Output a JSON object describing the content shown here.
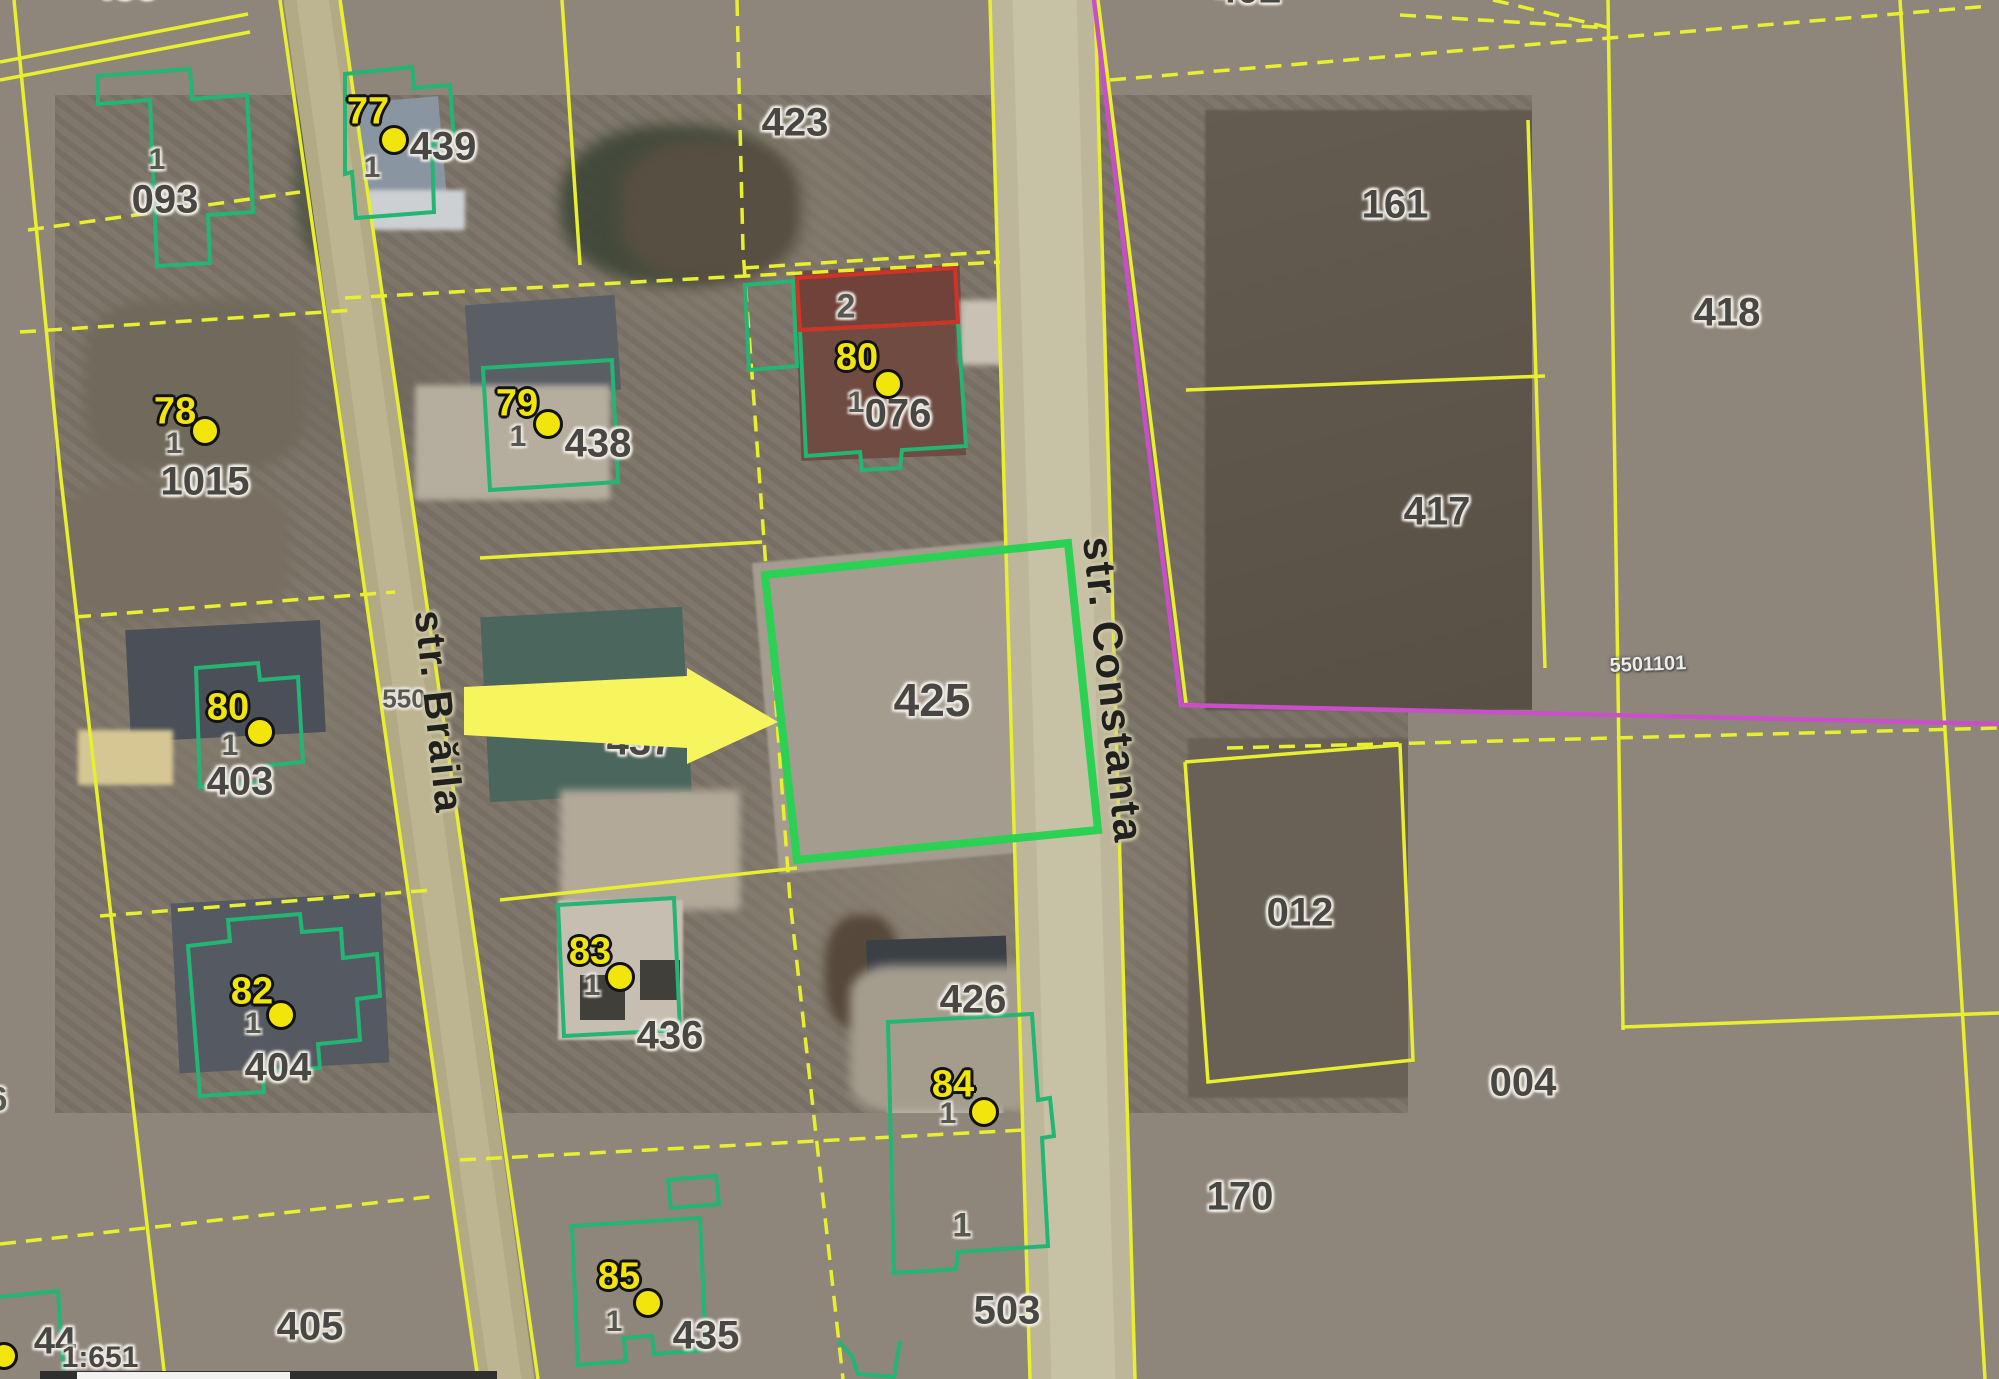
{
  "map": {
    "scale_text": "1:651",
    "corner_marker": "44",
    "highlighted_parcel": "425",
    "edge_fragment": "6"
  },
  "colors": {
    "background": "#8e857b",
    "parcel_line": "#e8ef2e",
    "building_outline": "#22b573",
    "highlight_outline": "#2bd153",
    "red_outline": "#cf3226",
    "restriction_line": "#c94fc9",
    "marker_yellow": "#f2e50c",
    "arrow_fill": "#f7f55e",
    "road_fill": "#b2aa84"
  },
  "streets": [
    {
      "name": "str. Brăila",
      "x": 438,
      "y": 712,
      "rot": 84,
      "size": 40
    },
    {
      "name": "str. Constanta",
      "x": 1113,
      "y": 690,
      "rot": 84,
      "size": 42
    }
  ],
  "parcel_labels": [
    {
      "text": "093",
      "x": 165,
      "y": 200,
      "size": 40
    },
    {
      "text": "1015",
      "x": 205,
      "y": 482,
      "size": 40
    },
    {
      "text": "403",
      "x": 240,
      "y": 782,
      "size": 40
    },
    {
      "text": "404",
      "x": 278,
      "y": 1068,
      "size": 40
    },
    {
      "text": "405",
      "x": 310,
      "y": 1327,
      "size": 40
    },
    {
      "text": "435",
      "x": 706,
      "y": 1336,
      "size": 40
    },
    {
      "text": "436",
      "x": 670,
      "y": 1036,
      "size": 40
    },
    {
      "text": "437",
      "x": 640,
      "y": 742,
      "size": 40
    },
    {
      "text": "438",
      "x": 598,
      "y": 444,
      "size": 40
    },
    {
      "text": "439",
      "x": 443,
      "y": 147,
      "size": 40
    },
    {
      "text": "423",
      "x": 795,
      "y": 123,
      "size": 40
    },
    {
      "text": "425",
      "x": 932,
      "y": 700,
      "size": 46
    },
    {
      "text": "426",
      "x": 973,
      "y": 1000,
      "size": 40
    },
    {
      "text": "076",
      "x": 898,
      "y": 414,
      "size": 40
    },
    {
      "text": "503",
      "x": 1007,
      "y": 1311,
      "size": 40
    },
    {
      "text": "161",
      "x": 1395,
      "y": 205,
      "size": 40
    },
    {
      "text": "417",
      "x": 1437,
      "y": 512,
      "size": 40
    },
    {
      "text": "418",
      "x": 1727,
      "y": 313,
      "size": 40
    },
    {
      "text": "012",
      "x": 1300,
      "y": 913,
      "size": 40
    },
    {
      "text": "004",
      "x": 1523,
      "y": 1083,
      "size": 40
    },
    {
      "text": "170",
      "x": 1240,
      "y": 1197,
      "size": 40
    },
    {
      "text": "402",
      "x": 1248,
      "y": -10,
      "size": 40
    },
    {
      "text": "400",
      "x": 125,
      "y": -14,
      "size": 40
    }
  ],
  "small_labels": [
    {
      "text": "1",
      "x": 157,
      "y": 160,
      "size": 30
    },
    {
      "text": "1",
      "x": 962,
      "y": 1226,
      "size": 34
    },
    {
      "text": "2",
      "x": 846,
      "y": 307,
      "size": 34
    },
    {
      "text": "550",
      "x": 404,
      "y": 699,
      "size": 26
    },
    {
      "text": "6",
      "x": -2,
      "y": 1100,
      "size": 34
    }
  ],
  "ref_labels": [
    {
      "text": "5501101",
      "x": 1648,
      "y": 665,
      "size": 20
    }
  ],
  "corner_labels": [
    {
      "text": "44",
      "x": 55,
      "y": 1342,
      "size": 38
    },
    {
      "text": "1:651",
      "x": 100,
      "y": 1358,
      "size": 30
    }
  ],
  "markers": [
    {
      "num": "77",
      "nx": 368,
      "ny": 112,
      "dx": 394,
      "dy": 140,
      "ox": 372,
      "oy": 168
    },
    {
      "num": "78",
      "nx": 175,
      "ny": 412,
      "dx": 205,
      "dy": 431,
      "ox": 174,
      "oy": 444
    },
    {
      "num": "79",
      "nx": 517,
      "ny": 404,
      "dx": 548,
      "dy": 424,
      "ox": 518,
      "oy": 437
    },
    {
      "num": "80",
      "nx": 857,
      "ny": 358,
      "dx": 888,
      "dy": 384,
      "ox": 856,
      "oy": 403
    },
    {
      "num": "80",
      "nx": 228,
      "ny": 708,
      "dx": 260,
      "dy": 732,
      "ox": 230,
      "oy": 746
    },
    {
      "num": "82",
      "nx": 252,
      "ny": 992,
      "dx": 281,
      "dy": 1015,
      "ox": 253,
      "oy": 1024
    },
    {
      "num": "83",
      "nx": 590,
      "ny": 952,
      "dx": 620,
      "dy": 977,
      "ox": 592,
      "oy": 986
    },
    {
      "num": "84",
      "nx": 953,
      "ny": 1085,
      "dx": 984,
      "dy": 1112,
      "ox": 948,
      "oy": 1114
    },
    {
      "num": "85",
      "nx": 619,
      "ny": 1277,
      "dx": 648,
      "dy": 1303,
      "ox": 614,
      "oy": 1322
    }
  ],
  "geometry": {
    "roads": [
      {
        "p": [
          [
            310,
            -20
          ],
          [
            508,
            1399
          ]
        ],
        "w": 58,
        "c": "#b2aa84"
      },
      {
        "p": [
          [
            310,
            -20
          ],
          [
            508,
            1399
          ]
        ],
        "w": 32,
        "c": "#bdb591"
      },
      {
        "p": [
          [
            1042,
            -20
          ],
          [
            1082,
            1399
          ]
        ],
        "w": 106,
        "c": "#bdb69a"
      },
      {
        "p": [
          [
            1044,
            -20
          ],
          [
            1084,
            1399
          ]
        ],
        "w": 64,
        "c": "#c7c1a6"
      }
    ],
    "yellow_lines": [
      {
        "p": [
          [
            0,
            62
          ],
          [
            248,
            14
          ]
        ],
        "d": 0
      },
      {
        "p": [
          [
            0,
            80
          ],
          [
            250,
            32
          ]
        ],
        "d": 0
      },
      {
        "p": [
          [
            14,
            0
          ],
          [
            60,
            470
          ],
          [
            108,
            890
          ],
          [
            165,
            1379
          ]
        ],
        "d": 0
      },
      {
        "p": [
          [
            28,
            230
          ],
          [
            300,
            192
          ]
        ],
        "d": 1
      },
      {
        "p": [
          [
            20,
            332
          ],
          [
            355,
            310
          ]
        ],
        "d": 1
      },
      {
        "p": [
          [
            75,
            617
          ],
          [
            395,
            592
          ]
        ],
        "d": 1
      },
      {
        "p": [
          [
            100,
            916
          ],
          [
            432,
            890
          ]
        ],
        "d": 1
      },
      {
        "p": [
          [
            0,
            1244
          ],
          [
            437,
            1196
          ]
        ],
        "d": 1
      },
      {
        "p": [
          [
            280,
            0
          ],
          [
            478,
            1379
          ]
        ],
        "d": 0
      },
      {
        "p": [
          [
            340,
            0
          ],
          [
            538,
            1379
          ]
        ],
        "d": 0
      },
      {
        "p": [
          [
            562,
            0
          ],
          [
            580,
            265
          ]
        ],
        "d": 0
      },
      {
        "p": [
          [
            345,
            298
          ],
          [
            1000,
            262
          ]
        ],
        "d": 1
      },
      {
        "p": [
          [
            480,
            558
          ],
          [
            762,
            542
          ]
        ],
        "d": 0
      },
      {
        "p": [
          [
            500,
            900
          ],
          [
            797,
            868
          ]
        ],
        "d": 0
      },
      {
        "p": [
          [
            460,
            1160
          ],
          [
            1023,
            1130
          ]
        ],
        "d": 1
      },
      {
        "p": [
          [
            737,
            0
          ],
          [
            743,
            250
          ],
          [
            790,
            900
          ],
          [
            843,
            1379
          ]
        ],
        "d": 1
      },
      {
        "p": [
          [
            743,
            268
          ],
          [
            990,
            252
          ]
        ],
        "d": 1
      },
      {
        "p": [
          [
            990,
            0
          ],
          [
            1030,
            1379
          ]
        ],
        "d": 0
      },
      {
        "p": [
          [
            1095,
            0
          ],
          [
            1135,
            1379
          ]
        ],
        "d": 0
      },
      {
        "p": [
          [
            1098,
            0
          ],
          [
            1186,
            703
          ]
        ],
        "d": 0
      },
      {
        "p": [
          [
            1186,
            390
          ],
          [
            1545,
            376
          ]
        ],
        "d": 0
      },
      {
        "p": [
          [
            1528,
            120
          ],
          [
            1545,
            668
          ]
        ],
        "d": 0
      },
      {
        "p": [
          [
            1110,
            80
          ],
          [
            1990,
            6
          ]
        ],
        "d": 1
      },
      {
        "p": [
          [
            1608,
            0
          ],
          [
            1623,
            1030
          ]
        ],
        "d": 0
      },
      {
        "p": [
          [
            1900,
            0
          ],
          [
            1985,
            1379
          ]
        ],
        "d": 0
      },
      {
        "p": [
          [
            1227,
            748
          ],
          [
            1999,
            728
          ]
        ],
        "d": 1
      },
      {
        "p": [
          [
            1185,
            762
          ],
          [
            1400,
            745
          ],
          [
            1413,
            1060
          ],
          [
            1208,
            1082
          ],
          [
            1185,
            762
          ]
        ],
        "d": 0
      },
      {
        "p": [
          [
            1623,
            1027
          ],
          [
            1999,
            1013
          ]
        ],
        "d": 0
      },
      {
        "p": [
          [
            1400,
            15
          ],
          [
            1610,
            28
          ]
        ],
        "d": 1
      },
      {
        "p": [
          [
            1493,
            0
          ],
          [
            1610,
            28
          ]
        ],
        "d": 1
      }
    ],
    "magenta_lines": [
      {
        "p": [
          [
            1094,
            0
          ],
          [
            1140,
            380
          ],
          [
            1181,
            705
          ],
          [
            1999,
            724
          ]
        ]
      }
    ],
    "green_buildings": [
      {
        "p": [
          [
            98,
            76
          ],
          [
            190,
            69
          ],
          [
            192,
            99
          ],
          [
            247,
            95
          ],
          [
            253,
            212
          ],
          [
            208,
            215
          ],
          [
            210,
            263
          ],
          [
            157,
            266
          ],
          [
            150,
            100
          ],
          [
            98,
            104
          ]
        ],
        "close": 1
      },
      {
        "p": [
          [
            345,
            74
          ],
          [
            412,
            67
          ],
          [
            414,
            88
          ],
          [
            450,
            85
          ],
          [
            454,
            142
          ],
          [
            432,
            144
          ],
          [
            434,
            212
          ],
          [
            356,
            218
          ],
          [
            352,
            172
          ],
          [
            345,
            174
          ]
        ],
        "close": 1
      },
      {
        "p": [
          [
            483,
            368
          ],
          [
            612,
            360
          ],
          [
            618,
            482
          ],
          [
            490,
            490
          ]
        ],
        "close": 1
      },
      {
        "p": [
          [
            800,
            330
          ],
          [
            958,
            322
          ],
          [
            966,
            446
          ],
          [
            902,
            450
          ],
          [
            900,
            468
          ],
          [
            862,
            470
          ],
          [
            860,
            452
          ],
          [
            806,
            456
          ]
        ],
        "close": 1
      },
      {
        "p": [
          [
            745,
            285
          ],
          [
            793,
            281
          ],
          [
            797,
            366
          ],
          [
            749,
            370
          ]
        ],
        "close": 1
      },
      {
        "p": [
          [
            196,
            668
          ],
          [
            258,
            663
          ],
          [
            260,
            680
          ],
          [
            298,
            677
          ],
          [
            303,
            762
          ],
          [
            263,
            766
          ],
          [
            265,
            783
          ],
          [
            200,
            787
          ]
        ],
        "close": 1
      },
      {
        "p": [
          [
            188,
            946
          ],
          [
            230,
            941
          ],
          [
            228,
            920
          ],
          [
            300,
            914
          ],
          [
            302,
            932
          ],
          [
            341,
            929
          ],
          [
            343,
            958
          ],
          [
            377,
            954
          ],
          [
            380,
            996
          ],
          [
            357,
            999
          ],
          [
            360,
            1040
          ],
          [
            318,
            1044
          ],
          [
            320,
            1068
          ],
          [
            262,
            1072
          ],
          [
            264,
            1092
          ],
          [
            200,
            1096
          ]
        ],
        "close": 1
      },
      {
        "p": [
          [
            558,
            905
          ],
          [
            674,
            898
          ],
          [
            680,
            1030
          ],
          [
            564,
            1036
          ]
        ],
        "close": 1
      },
      {
        "p": [
          [
            888,
            1022
          ],
          [
            1032,
            1014
          ],
          [
            1038,
            1100
          ],
          [
            1050,
            1098
          ],
          [
            1054,
            1136
          ],
          [
            1042,
            1138
          ],
          [
            1048,
            1246
          ],
          [
            958,
            1252
          ],
          [
            956,
            1269
          ],
          [
            894,
            1273
          ]
        ],
        "close": 1
      },
      {
        "p": [
          [
            572,
            1226
          ],
          [
            700,
            1218
          ],
          [
            706,
            1350
          ],
          [
            654,
            1354
          ],
          [
            652,
            1336
          ],
          [
            624,
            1338
          ],
          [
            626,
            1361
          ],
          [
            578,
            1365
          ]
        ],
        "close": 1
      },
      {
        "p": [
          [
            668,
            1180
          ],
          [
            716,
            1176
          ],
          [
            719,
            1204
          ],
          [
            671,
            1208
          ]
        ],
        "close": 1
      },
      {
        "p": [
          [
            838,
            1341
          ],
          [
            852,
            1356
          ],
          [
            858,
            1374
          ],
          [
            894,
            1377
          ],
          [
            900,
            1341
          ]
        ],
        "close": 0
      },
      {
        "p": [
          [
            0,
            1297
          ],
          [
            58,
            1291
          ],
          [
            64,
            1379
          ]
        ],
        "close": 0
      }
    ],
    "red_building": {
      "p": [
        [
          797,
          278
        ],
        [
          955,
          268
        ],
        [
          958,
          322
        ],
        [
          800,
          330
        ]
      ]
    },
    "parcel_highlight": {
      "p": [
        [
          765,
          575
        ],
        [
          1068,
          543
        ],
        [
          1098,
          830
        ],
        [
          797,
          860
        ]
      ]
    },
    "arrow": {
      "p": [
        [
          464,
          687
        ],
        [
          687,
          676
        ],
        [
          687,
          668
        ],
        [
          778,
          722
        ],
        [
          687,
          764
        ],
        [
          687,
          748
        ],
        [
          464,
          735
        ]
      ]
    }
  }
}
